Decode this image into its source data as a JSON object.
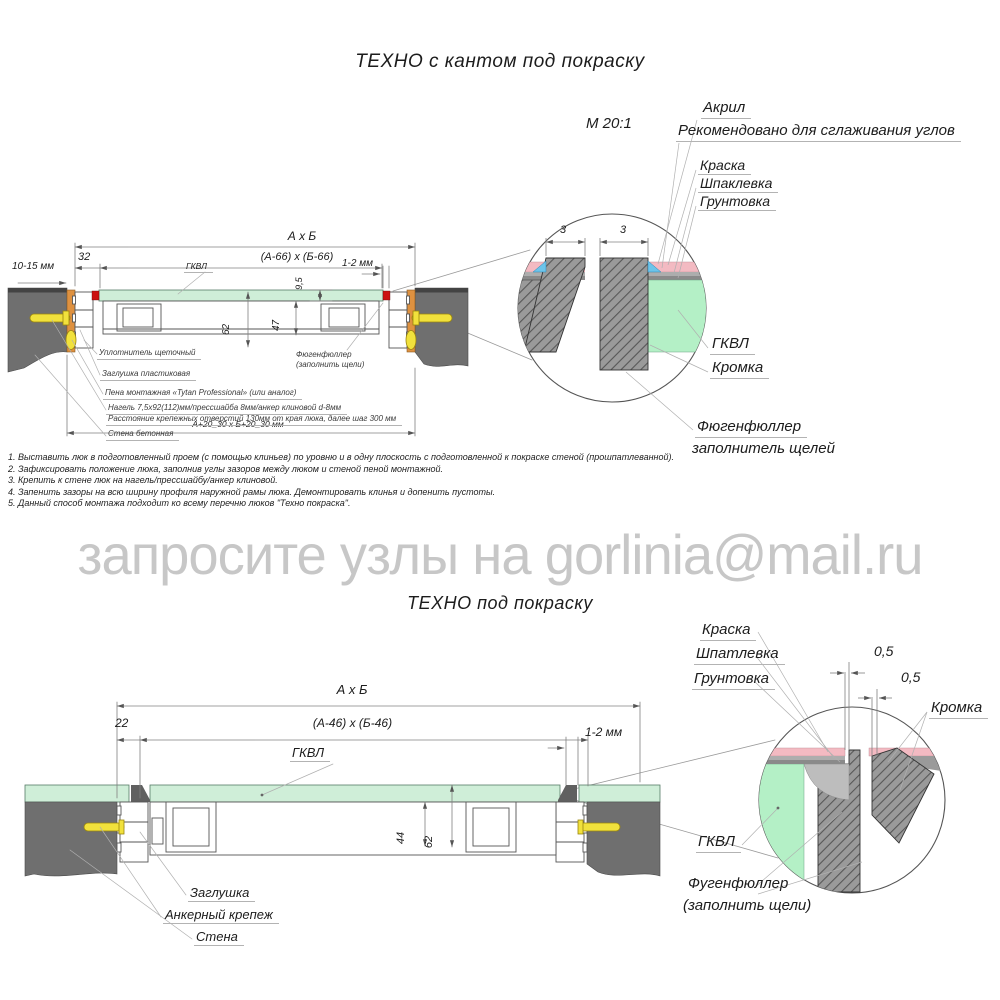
{
  "watermark": "запросите узлы на gorlinia@mail.ru",
  "colors": {
    "wall_gray": "#6f6f6f",
    "gkvl_green": "#cfeed8",
    "detail_green": "#b4f0c6",
    "paint_pink": "#f3bac2",
    "acrylic_blue": "#6cc4ea",
    "anchor_yellow": "#f1e13c",
    "wood_orange": "#de9140",
    "marker_red": "#cc1111",
    "watermark_gray": "#c7c7c7"
  },
  "top": {
    "title": "ТЕХНО с кантом под покраску",
    "scale": "М 20:1",
    "labels": {
      "acryl": "Акрил",
      "acryl_note": "Рекомендовано для сглаживания углов",
      "paint": "Краска",
      "putty": "Шпаклевка",
      "primer": "Грунтовка",
      "gkvl": "ГКВЛ",
      "edge": "Кромка",
      "filler_line1": "Фюгенфюллер",
      "filler_line2": "заполнитель щелей"
    },
    "dims": {
      "overall": "А х Б",
      "inner": "(А-66) х (Б-66)",
      "offset32": "32",
      "wall_gap": "10-15 мм",
      "slit": "1-2 мм",
      "panel_t": "9,5",
      "frame_h": "62",
      "lid_h": "47",
      "detail_gap_l": "3",
      "detail_gap_r": "3",
      "opening": "А+20_30 х Б+20_30 мм",
      "gkvl_small": "ГКВЛ"
    },
    "callouts": {
      "brush_seal": "Уплотнитель щеточный",
      "plug": "Заглушка пластиковая",
      "foam": "Пена монтажная «Tytan Professional» (или аналог)",
      "dowel": "Нагель 7,5х92(112)мм/прессшайба 8мм/анкер клиновой d-8мм",
      "dowel_spacing": "Расстояние крепежных отверстий 130мм от края люка, далее шаг 300 мм",
      "wall": "Стена бетонная",
      "filler_line1": "Фюгенфюллер",
      "filler_line2": "(заполнить щели)"
    },
    "notes": [
      "1. Выставить люк в подготовленный проем (с помощью клиньев) по уровню и в одну плоскость с подготовленной к покраске стеной (прошпатлеванной).",
      "2. Зафиксировать положение люка, заполнив углы зазоров между люком и стеной пеной монтажной.",
      "3. Крепить к стене люк на нагель/прессшайбу/анкер клиновой.",
      "4. Запенить зазоры на всю ширину профиля наружной рамы люка. Демонтировать клинья и допенить пустоты.",
      "5. Данный способ монтажа подходит ко всему перечню люков \"Техно покраска\"."
    ]
  },
  "bottom": {
    "title": "ТЕХНО под покраску",
    "labels": {
      "paint": "Краска",
      "putty": "Шпатлевка",
      "primer": "Грунтовка",
      "edge": "Кромка",
      "gkvl_detail": "ГКВЛ",
      "filler_line1": "Фугенфюллер",
      "filler_line2": "(заполнить щели)",
      "gkvl_main": "ГКВЛ",
      "plug": "Заглушка",
      "anchor": "Анкерный крепеж",
      "wall": "Стена"
    },
    "dims": {
      "overall": "А х Б",
      "inner": "(А-46) х (Б-46)",
      "offset22": "22",
      "slit": "1-2 мм",
      "lid_h": "44",
      "frame_h": "62",
      "gap1": "0,5",
      "gap2": "0,5"
    }
  }
}
